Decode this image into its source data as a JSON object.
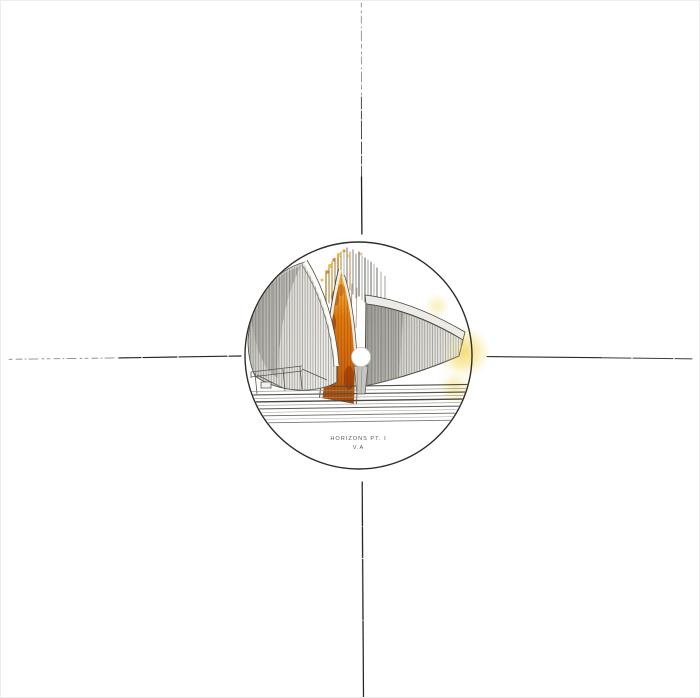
{
  "label": {
    "title": "HORIZONS PT. I",
    "subtitle": "V.A"
  },
  "colors": {
    "sleeve_background": "#ffffff",
    "sketch_line_dark": "#222222",
    "sketch_line_faint": "#8a8a8a",
    "circle_outline": "#2f2d29",
    "label_text": "#5a5a58",
    "wedge_amber": "#f6c044",
    "wedge_orange": "#e07b10",
    "wedge_deep": "#a84a08",
    "glow_yellow": "#f3dc74",
    "structure_gray": "#b9b8b3"
  }
}
